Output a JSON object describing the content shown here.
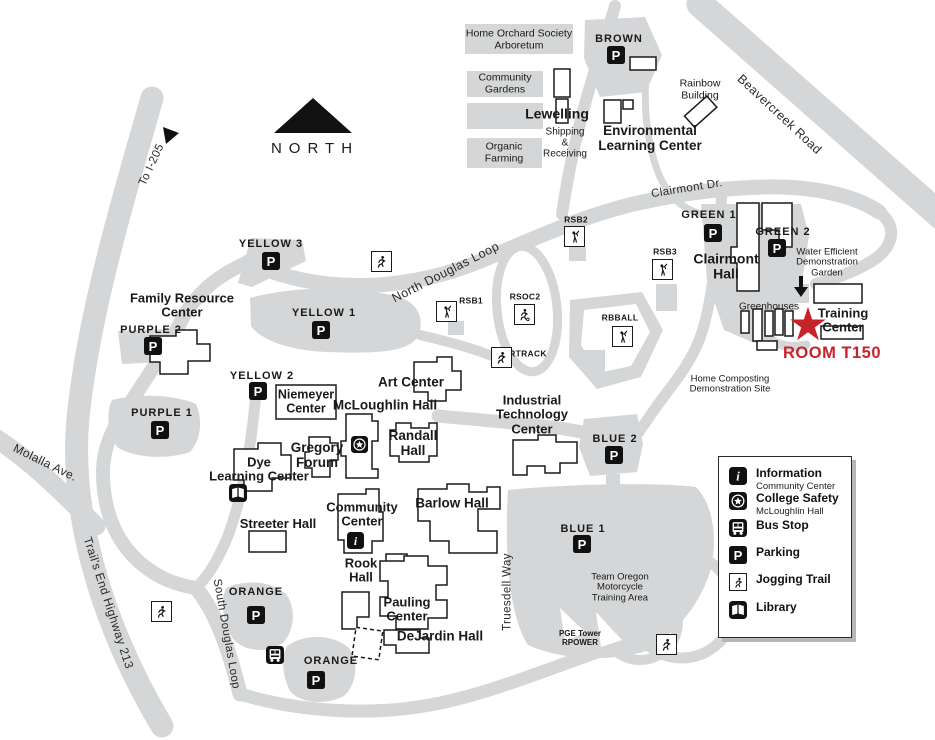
{
  "colors": {
    "map_gray": "#d5d6d7",
    "accent_red": "#c8222b",
    "icon_black": "#111111"
  },
  "compass": {
    "label": "NORTH"
  },
  "roads": {
    "to_i205": "To I-205",
    "beavercreek": "Beavercreek Road",
    "clairmont_dr": "Clairmont Dr.",
    "north_douglas": "North Douglas Loop",
    "south_douglas": "South Douglas Loop",
    "molalla": "Molalla Ave.",
    "trails_end": "Trail's End Highway 213",
    "truesdell": "Truesdell Way"
  },
  "areas": {
    "arboretum": "Home Orchard Society\nArboretum",
    "community_gardens": "Community\nGardens",
    "organic_farming": "Organic\nFarming",
    "shipping": "Shipping\n&\nReceiving",
    "rainbow": "Rainbow\nBuilding",
    "water_garden": "Water Efficient\nDemonstration\nGarden",
    "greenhouses": "Greenhouses",
    "home_composting": "Home Composting\nDemonstration Site",
    "team_oregon": "Team Oregon\nMotorcycle\nTraining Area",
    "pge_tower": "PGE Tower\nRPOWER"
  },
  "buildings": {
    "lewelling": "Lewelling",
    "environmental": "Environmental\nLearning Center",
    "clairmont_hall": "Clairmont\nHall",
    "training_center": "Training\nCenter",
    "family_resource": "Family Resource\nCenter",
    "niemeyer": "Niemeyer\nCenter",
    "mcloughlin": "McLoughlin Hall",
    "art_center": "Art Center",
    "gregory": "Gregory\nForum",
    "randall": "Randall\nHall",
    "dye": "Dye\nLearning Center",
    "streeter": "Streeter Hall",
    "community_center": "Community\nCenter",
    "barlow": "Barlow Hall",
    "rook": "Rook\nHall",
    "pauling": "Pauling\nCenter",
    "dejardin": "DeJardin Hall",
    "itc": "Industrial\nTechnology\nCenter"
  },
  "parking": {
    "brown": "BROWN",
    "green1": "GREEN 1",
    "green2": "GREEN 2",
    "yellow1": "YELLOW 1",
    "yellow2": "YELLOW 2",
    "yellow3": "YELLOW 3",
    "purple1": "PURPLE 1",
    "purple2": "PURPLE 2",
    "blue1": "BLUE 1",
    "blue2": "BLUE 2",
    "orange": "ORANGE"
  },
  "sports": {
    "rsb1": "RSB1",
    "rsb2": "RSB2",
    "rsb3": "RSB3",
    "rsoc2": "RSOC2",
    "rtrack": "RTRACK",
    "rbball": "RBBALL"
  },
  "highlight": {
    "room": "ROOM T150",
    "marker": "★"
  },
  "legend": {
    "items": [
      {
        "icon": "information-icon",
        "label": "Information",
        "sub": "Community Center"
      },
      {
        "icon": "college-safety-icon",
        "label": "College Safety",
        "sub": "McLoughlin Hall"
      },
      {
        "icon": "bus-stop-icon",
        "label": "Bus Stop",
        "sub": ""
      },
      {
        "icon": "parking-icon",
        "label": "Parking",
        "sub": ""
      },
      {
        "icon": "jogging-trail-icon",
        "label": "Jogging Trail",
        "sub": ""
      },
      {
        "icon": "library-icon",
        "label": "Library",
        "sub": ""
      }
    ]
  }
}
